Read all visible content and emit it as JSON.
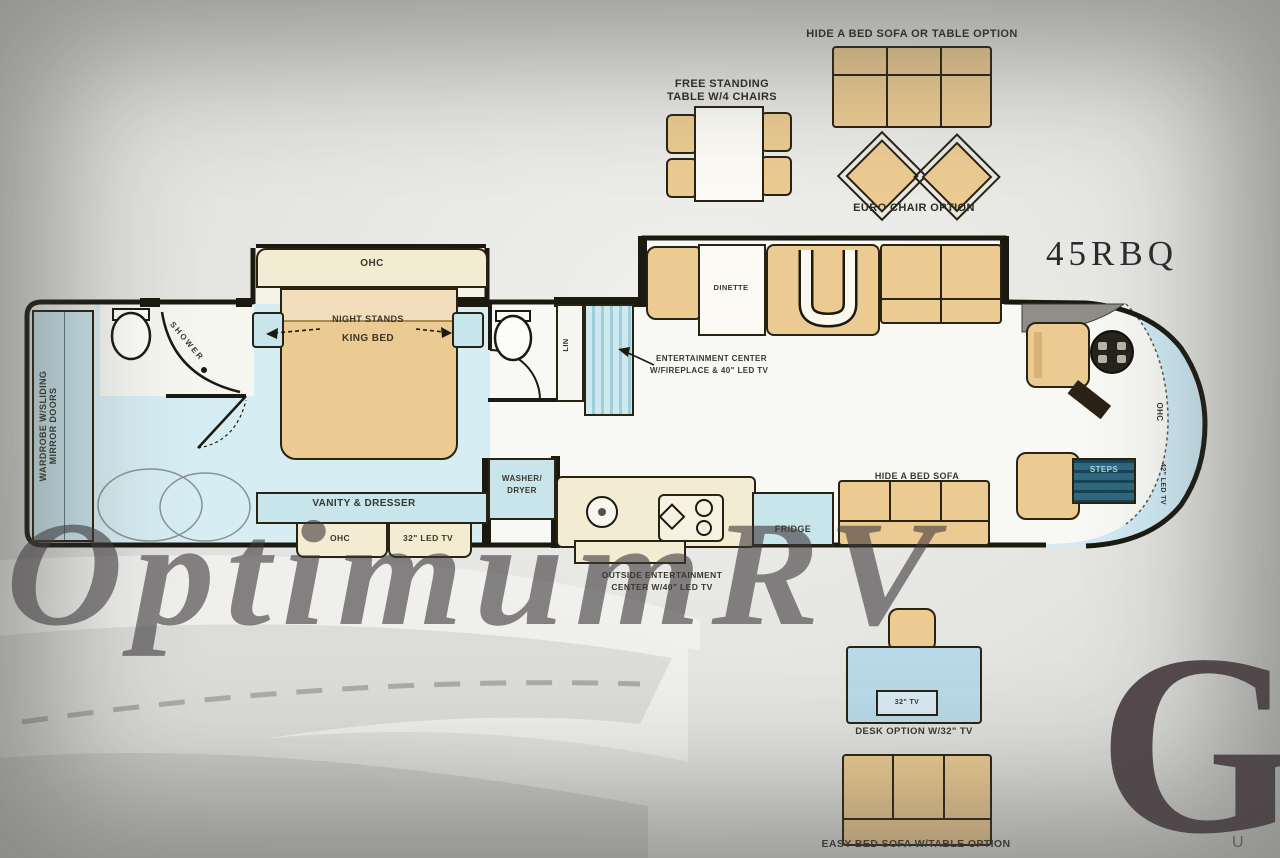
{
  "title": "45RBQ",
  "watermark": "OptimumRV",
  "logo_letter": "G",
  "corner_letter": "U",
  "colors": {
    "furniture_tan": "#eccb92",
    "cabinet_blue": "#c8e5ec",
    "overhead_cream": "#f3ecd3",
    "steps_teal": "#1e5a72",
    "wall_black": "#1b1910"
  },
  "options_top": {
    "sofa_caption": "HIDE A BED SOFA OR TABLE OPTION",
    "euro_chair_caption": "EURO CHAIR OPTION",
    "table_caption_line1": "FREE STANDING",
    "table_caption_line2": "TABLE W/4 CHAIRS"
  },
  "bedroom": {
    "ohc_headboard": "OHC",
    "night_stands": "NIGHT STANDS",
    "king_bed": "KING BED",
    "shower": "SHOWER",
    "wardrobe_line1": "WARDROBE W/SLIDING",
    "wardrobe_line2": "MIRROR DOORS",
    "vanity": "VANITY & DRESSER",
    "ohc_footboard": "OHC",
    "tv": "32\" LED TV"
  },
  "utility": {
    "washer_line1": "WASHER/",
    "washer_line2": "DRYER",
    "linen": "LIN"
  },
  "living": {
    "dinette": "DINETTE",
    "entertainment_line1": "ENTERTAINMENT CENTER",
    "entertainment_line2": "W/FIREPLACE & 40\" LED TV",
    "fridge": "FRIDGE",
    "hide_a_bed": "HIDE A BED SOFA",
    "outside_line1": "OUTSIDE ENTERTAINMENT",
    "outside_line2": "CENTER W/40\" LED TV"
  },
  "cockpit": {
    "steps": "STEPS",
    "ohc": "OHC",
    "tv": "42\" LED TV"
  },
  "options_bottom": {
    "desk_tv": "32\" TV",
    "desk_caption": "DESK OPTION W/32\" TV",
    "easy_sofa_caption": "EASY BED SOFA W/TABLE OPTION"
  }
}
